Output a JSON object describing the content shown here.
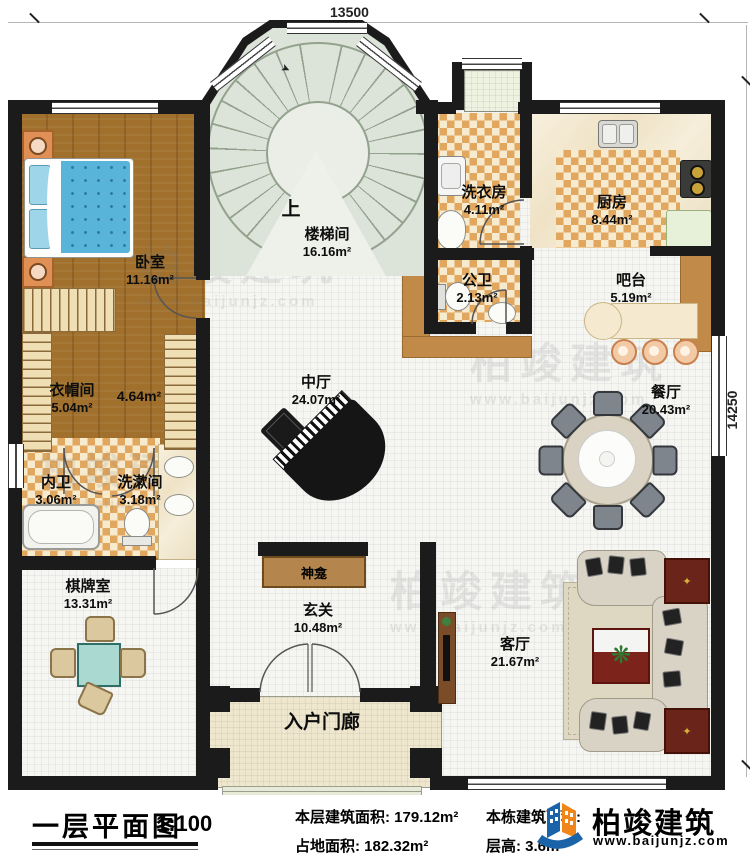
{
  "dimensions": {
    "top": "13500",
    "right": "14250"
  },
  "stair": {
    "up": "上"
  },
  "rooms": {
    "bedroom": {
      "label": "卧室",
      "area": "11.16m²"
    },
    "stairwell": {
      "label": "楼梯间",
      "area": "16.16m²"
    },
    "laundry": {
      "label": "洗衣房",
      "area": "4.11m²"
    },
    "kitchen": {
      "label": "厨房",
      "area": "8.44m²"
    },
    "public_wc": {
      "label": "公卫",
      "area": "2.13m²"
    },
    "bar": {
      "label": "吧台",
      "area": "5.19m²"
    },
    "cloakroom": {
      "label": "衣帽间",
      "area": "5.04m²"
    },
    "corridor": {
      "area": "4.64m²"
    },
    "central_hall": {
      "label": "中厅",
      "area": "24.07m²"
    },
    "dining": {
      "label": "餐厅",
      "area": "20.43m²"
    },
    "master_bath": {
      "label": "内卫",
      "area": "3.06m²"
    },
    "washroom": {
      "label": "洗漱间",
      "area": "3.18m²"
    },
    "game_room": {
      "label": "棋牌室",
      "area": "13.31m²"
    },
    "shrine": {
      "label": "神龛"
    },
    "foyer": {
      "label": "玄关",
      "area": "10.48m²"
    },
    "living": {
      "label": "客厅",
      "area": "21.67m²"
    },
    "porch": {
      "label": "入户门廊"
    }
  },
  "titleblock": {
    "title": "一层平面图",
    "scale": "1:100",
    "floor_area": "本层建筑面积: 179.12m²",
    "land_area": "占地面积: 182.32m²",
    "building_area": "本栋建筑面积:",
    "floor_height": "层高: 3.6m"
  },
  "logo": {
    "name": "柏竣建筑",
    "url": "www.baijunjz.com"
  },
  "watermark": {
    "text": "柏竣建筑",
    "url": "www.baijunjz.com"
  },
  "colors": {
    "wall": "#1b1b1b",
    "wood": "#a0702c",
    "tile_accent": "#e2a75f",
    "brand_blue": "#1b63a8",
    "brand_orange": "#f08519"
  }
}
